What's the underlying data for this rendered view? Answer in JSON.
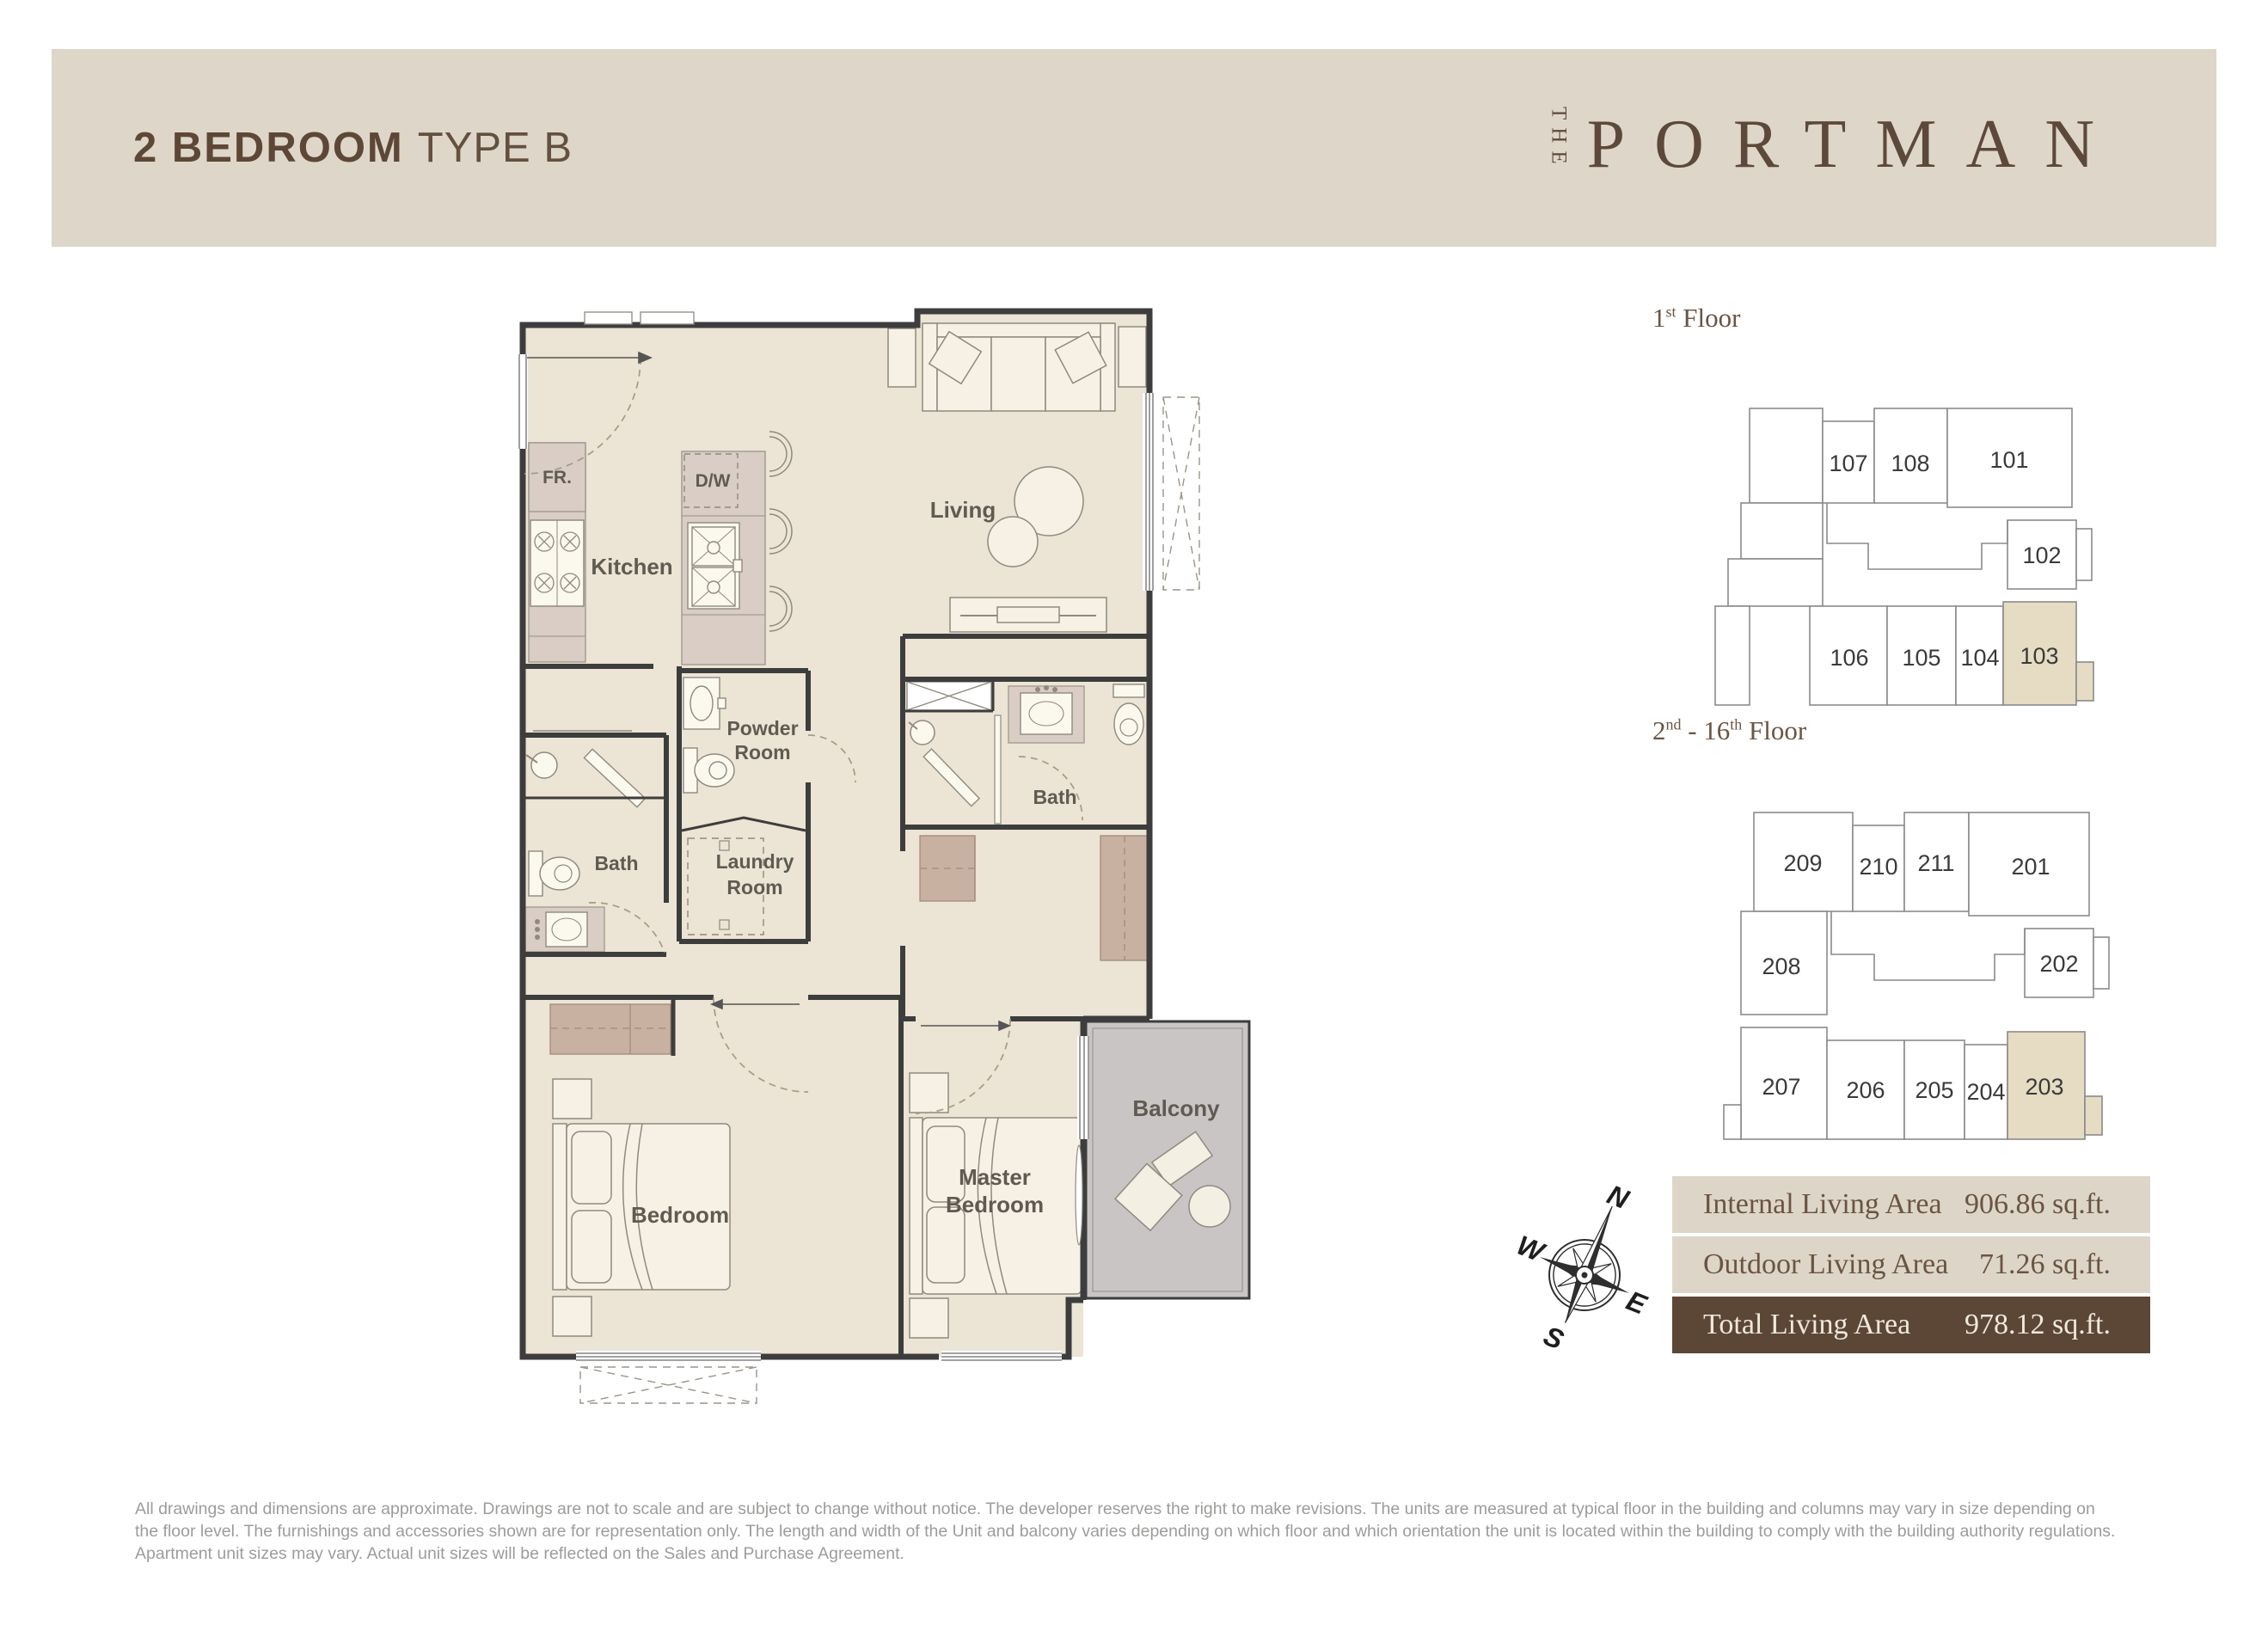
{
  "header": {
    "title_bold": "2 BEDROOM",
    "title_regular": "TYPE B",
    "logo_the": "THE",
    "logo_name": "PORTMAN"
  },
  "plan": {
    "fr": "FR.",
    "dw": "D/W",
    "kitchen": "Kitchen",
    "living": "Living",
    "powder_1": "Powder",
    "powder_2": "Room",
    "bath_left": "Bath",
    "laundry_1": "Laundry",
    "laundry_2": "Room",
    "bath_right": "Bath",
    "bedroom": "Bedroom",
    "master_1": "Master",
    "master_2": "Bedroom",
    "balcony": "Balcony"
  },
  "key_plan_1": {
    "t_num": "1",
    "t_sup": "st",
    "t_rest": " Floor",
    "units": [
      "107",
      "108",
      "101",
      "102",
      "103",
      "104",
      "105",
      "106"
    ],
    "highlighted_unit": "103"
  },
  "key_plan_2": {
    "t_num": "2",
    "t_sup": "nd",
    "t_mid": " - 16",
    "t_sup2": "th",
    "t_rest": " Floor",
    "units": [
      "209",
      "210",
      "211",
      "201",
      "202",
      "208",
      "207",
      "206",
      "205",
      "204",
      "203"
    ],
    "highlighted_unit": "203"
  },
  "compass": {
    "north": "N",
    "east": "E",
    "south": "S",
    "west": "W"
  },
  "area_table": {
    "rows": [
      {
        "label": "Internal Living Area",
        "value": "906.86 sq.ft."
      },
      {
        "label": "Outdoor Living Area",
        "value": "71.26 sq.ft."
      },
      {
        "label": "Total Living Area",
        "value": "978.12 sq.ft."
      }
    ]
  },
  "disclaimer": "All drawings and dimensions are approximate. Drawings are not to scale and are subject to change without notice. The developer reserves the right to make revisions. The units are measured at typical floor in the building and columns may vary in size depending on the floor level. The furnishings and accessories shown are for representation only. The length and width of the Unit and balcony varies depending on which floor and which orientation the unit is located within the building to comply with the building authority regulations. Apartment unit sizes may vary. Actual unit sizes will be reflected on the Sales and Purchase Agreement.",
  "colors": {
    "header_bar": "#ded7c9",
    "brand_brown": "#5d493c",
    "table_dark": "#5c4737",
    "table_light": "#ddd6c8",
    "highlight_unit": "#e6dcc3",
    "balcony_fill": "#c8c5c4",
    "floor_fill": "#ece4d4",
    "wall": "#3d3d3d"
  }
}
